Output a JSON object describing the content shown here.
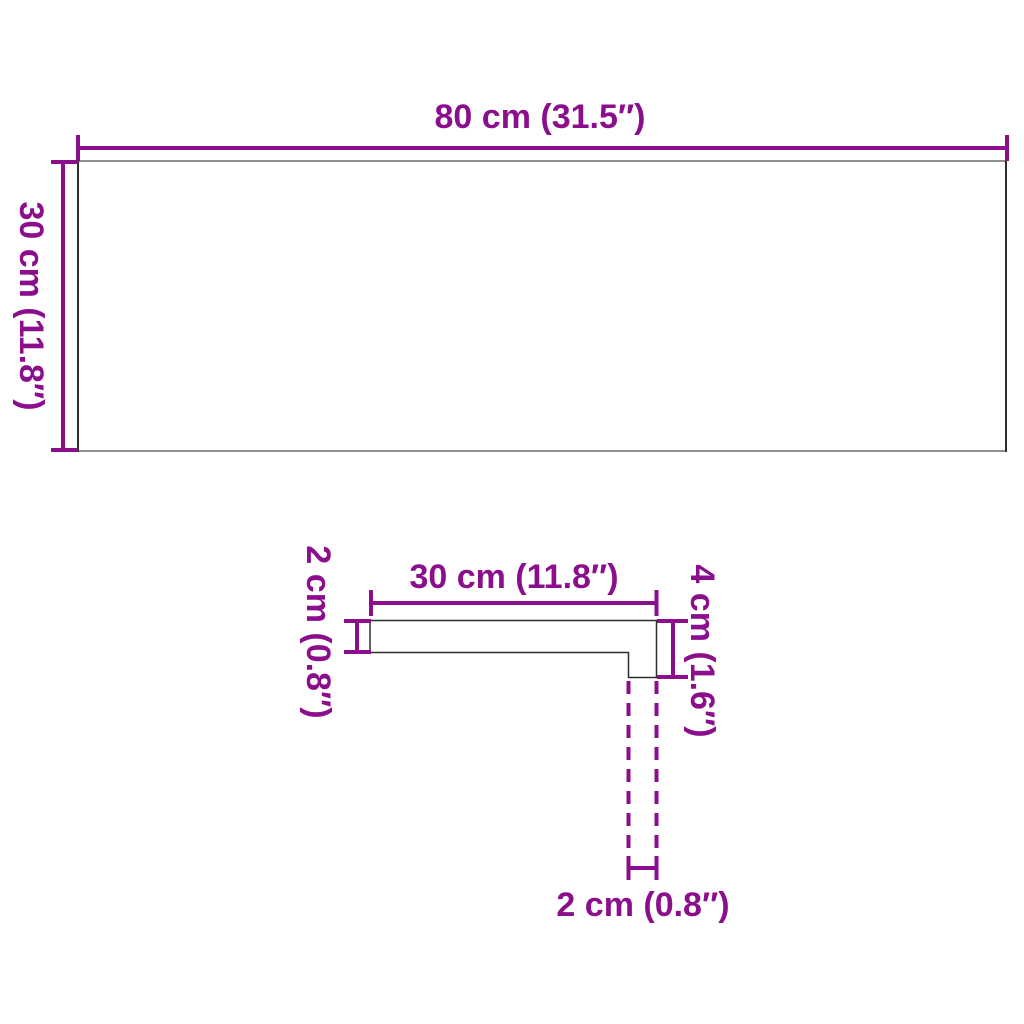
{
  "colors": {
    "dimension_accent": "#8B0E8C",
    "outline_dark": "#2E2E2E",
    "outline_gray": "#8F8F8F"
  },
  "top_view": {
    "width_label": "80 cm (31.5″)",
    "height_label": "30 cm (11.8″)",
    "width_cm": 80,
    "width_inches": 31.5,
    "height_cm": 30,
    "height_inches": 11.8
  },
  "profile_view": {
    "top_width_label": "30 cm (11.8″)",
    "left_thickness_label": "2 cm (0.8″)",
    "right_height_label": "4 cm (1.6″)",
    "bottom_nose_label": "2 cm (0.8″)",
    "top_width_cm": 30,
    "top_width_inches": 11.8,
    "thickness_cm": 2,
    "thickness_inches": 0.8,
    "nose_height_cm": 4,
    "nose_height_inches": 1.6,
    "nose_width_cm": 2,
    "nose_width_inches": 0.8
  }
}
